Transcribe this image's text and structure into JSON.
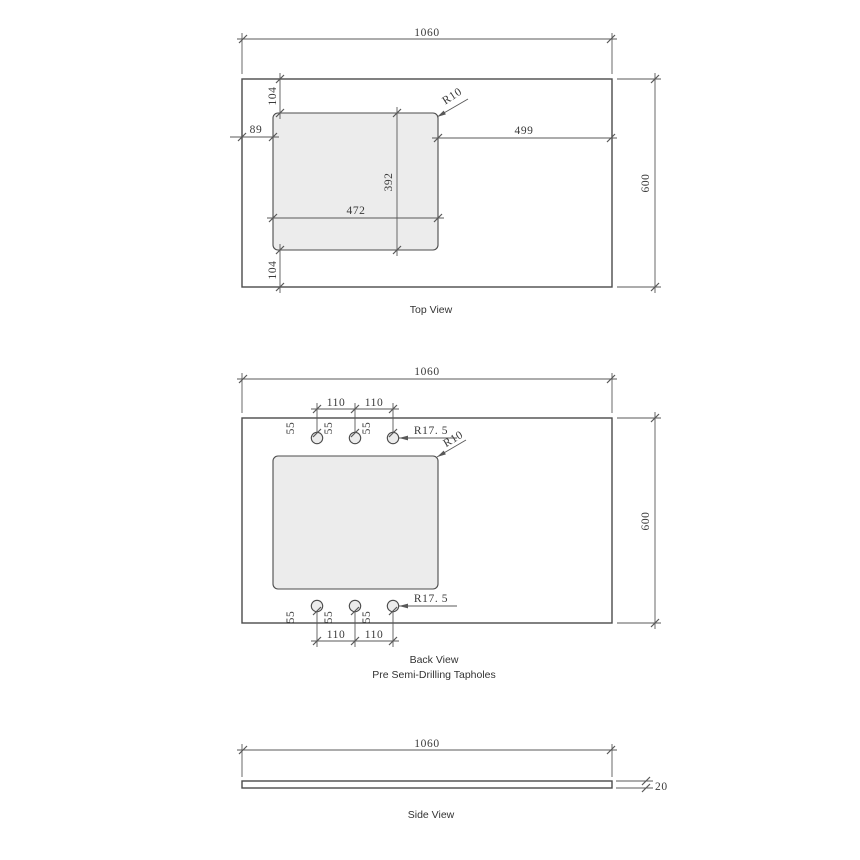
{
  "colors": {
    "background": "#ffffff",
    "object_line": "#4b4b4b",
    "dim_line": "#585858",
    "dim_text": "#3a3a3a",
    "label_text": "#333333",
    "cutout_fill": "#ececec"
  },
  "top_view": {
    "label": "Top View",
    "overall_width": "1060",
    "overall_depth": "600",
    "cutout_offset_top": "104",
    "cutout_offset_left": "89",
    "right_of_cutout": "499",
    "cutout_width": "472",
    "cutout_depth": "392",
    "cutout_offset_bottom": "104",
    "corner_radius": "R10"
  },
  "back_view": {
    "label": "Back View",
    "sublabel": "Pre Semi-Drilling Tapholes",
    "overall_width": "1060",
    "overall_depth": "600",
    "corner_radius": "R10",
    "tapholes_top": {
      "spacing": [
        "110",
        "110"
      ],
      "edge_offsets": [
        "55",
        "55",
        "55"
      ],
      "radius": "R17. 5"
    },
    "tapholes_bottom": {
      "spacing": [
        "110",
        "110"
      ],
      "edge_offsets": [
        "55",
        "55",
        "55"
      ],
      "radius": "R17. 5"
    }
  },
  "side_view": {
    "label": "Side View",
    "overall_width": "1060",
    "thickness": "20"
  }
}
